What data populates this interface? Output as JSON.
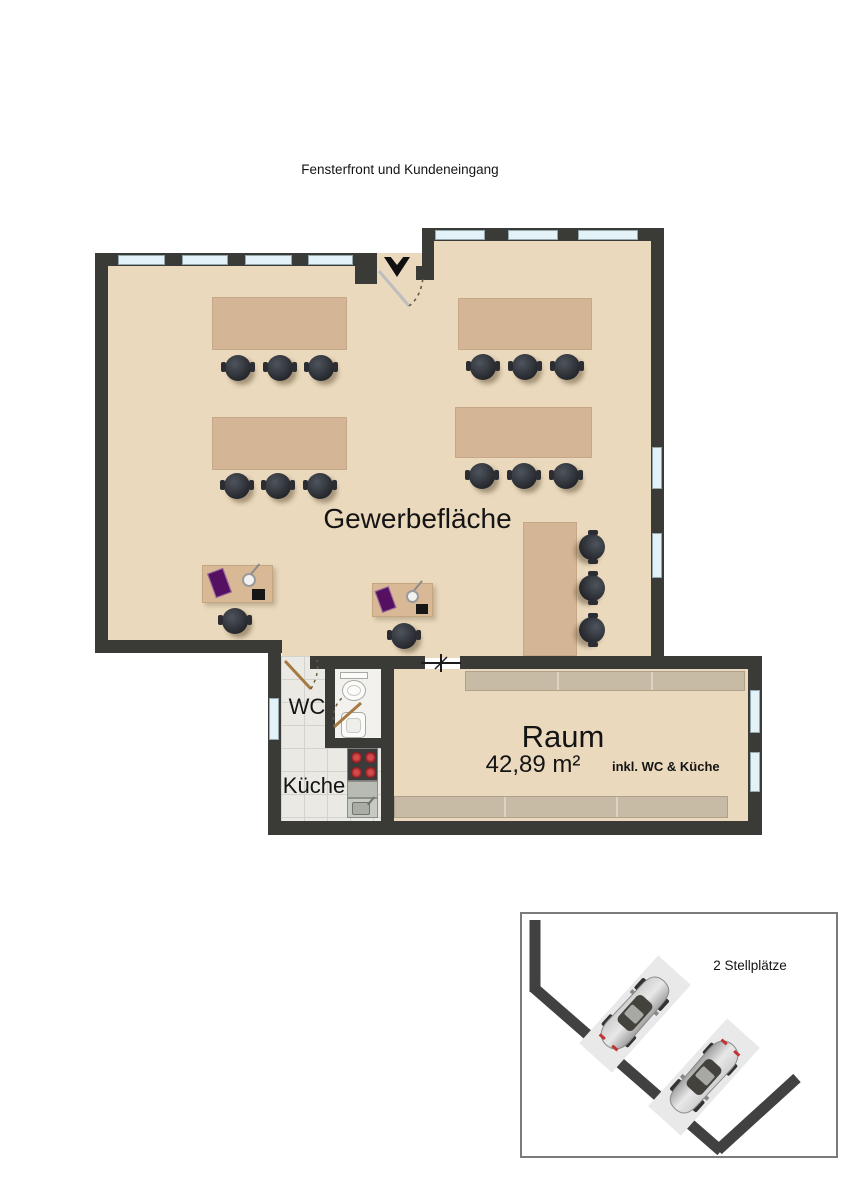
{
  "annotation": {
    "top_label": "Fensterfront und Kundeneingang"
  },
  "floorplan": {
    "main_room": {
      "label": "Gewerbefläche"
    },
    "wc": {
      "label": "WC"
    },
    "kitchen": {
      "label": "Küche"
    },
    "room": {
      "label": "Raum",
      "area": "42,89 m²",
      "area_suffix": "inkl. WC & Küche"
    },
    "furniture": {
      "large_tables": 4,
      "table_chairs": 12,
      "desks": 2,
      "desk_chairs": 2,
      "counter_chairs": 3
    }
  },
  "parking": {
    "label": "2 Stellplätze",
    "cars": 2
  },
  "colors": {
    "floor": "#ead9bd",
    "table": "#d4b595",
    "wall": "#3a3a37",
    "window": "#e3f2f8",
    "tile": "#eae9e4",
    "shelf": "#c8bba5",
    "door": "#a5793f",
    "burner": "#bf2a2c",
    "laptop": "#551061"
  }
}
